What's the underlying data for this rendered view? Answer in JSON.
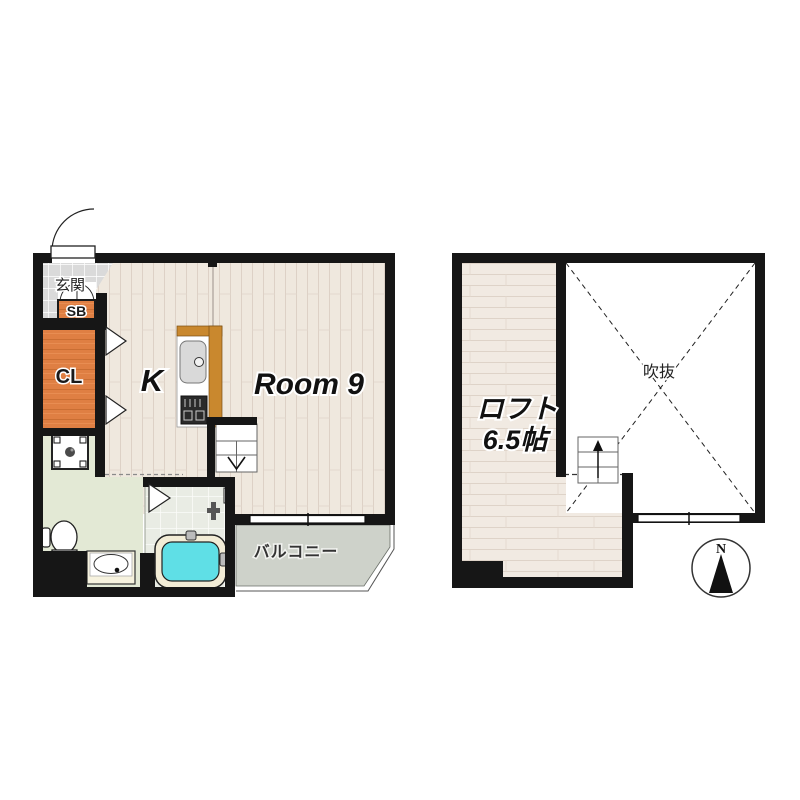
{
  "title": "apartment floor plan with loft",
  "first_floor": {
    "entrance": "玄関",
    "shoe_box": "SB",
    "closet": "CL",
    "kitchen": "K",
    "room": "Room 9",
    "balcony": "バルコニー"
  },
  "loft_floor": {
    "loft": "ロフト",
    "loft_size": "6.5帖",
    "void": "吹抜",
    "north": "N"
  },
  "colors": {
    "wall": "#161616",
    "flooring_wood": "#efe8de",
    "loft_wood": "#f1eae2",
    "closet_wood": "#df7f43",
    "counter_wood": "#c9882e",
    "entrance_tile": "#dadada",
    "bathroom_tile": "#e9ece4",
    "washroom_floor": "#e3e9d5",
    "balcony_floor": "#ced2ca",
    "bathtub_water": "#5fdfe6",
    "void_fill": "#ffffff"
  }
}
